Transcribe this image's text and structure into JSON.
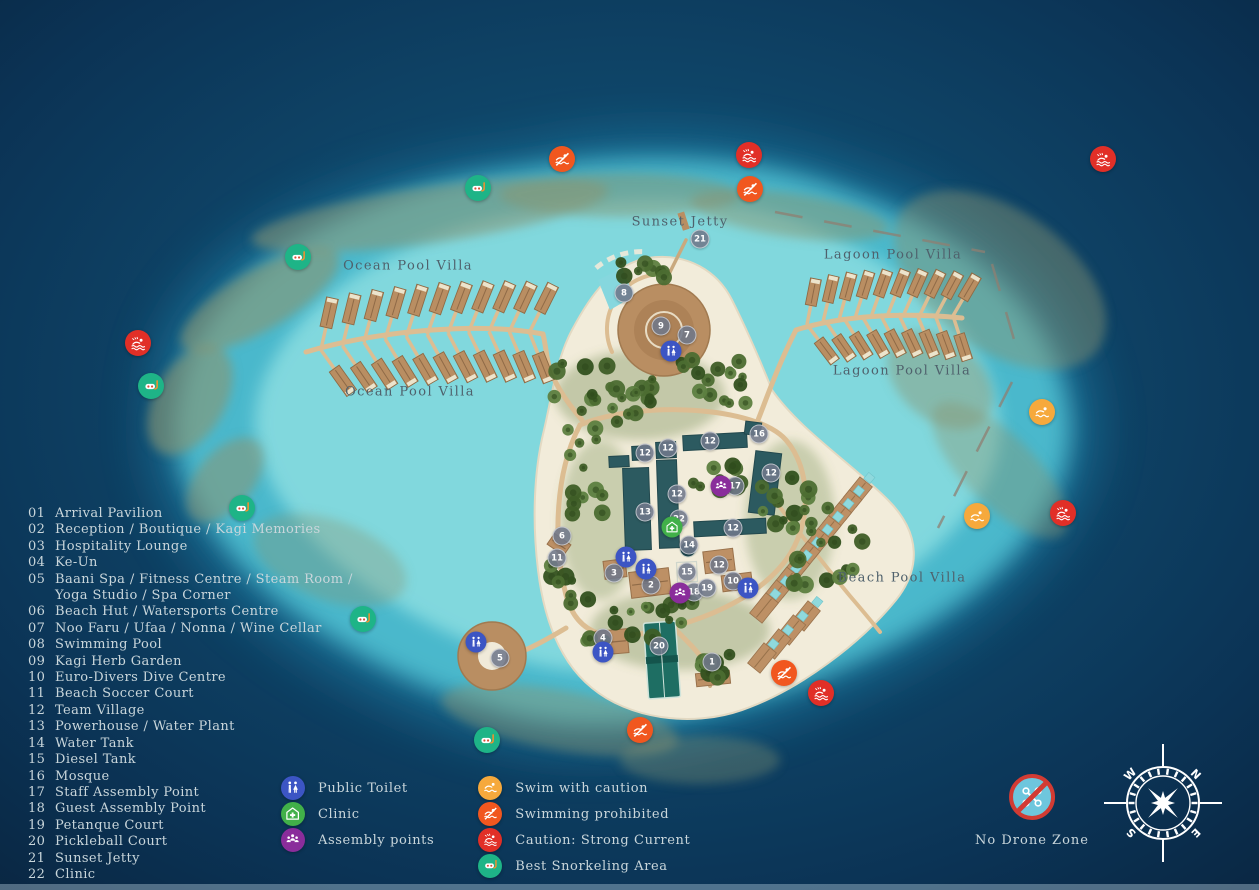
{
  "legend": {
    "items": [
      {
        "num": "01",
        "lines": [
          "Arrival Pavilion"
        ]
      },
      {
        "num": "02",
        "lines": [
          "Reception / Boutique / Kagi Memories"
        ]
      },
      {
        "num": "03",
        "lines": [
          "Hospitality Lounge"
        ]
      },
      {
        "num": "04",
        "lines": [
          "Ke-Un"
        ]
      },
      {
        "num": "05",
        "lines": [
          "Baani Spa / Fitness Centre / Steam Room /",
          "Yoga Studio  / Spa Corner"
        ]
      },
      {
        "num": "06",
        "lines": [
          "Beach Hut / Watersports Centre"
        ]
      },
      {
        "num": "07",
        "lines": [
          "Noo Faru / Ufaa / Nonna / Wine Cellar"
        ]
      },
      {
        "num": "08",
        "lines": [
          "Swimming Pool"
        ]
      },
      {
        "num": "09",
        "lines": [
          "Kagi Herb Garden"
        ]
      },
      {
        "num": "10",
        "lines": [
          "Euro-Divers Dive Centre"
        ]
      },
      {
        "num": "11",
        "lines": [
          "Beach Soccer Court"
        ]
      },
      {
        "num": "12",
        "lines": [
          "Team Village"
        ]
      },
      {
        "num": "13",
        "lines": [
          "Powerhouse / Water Plant"
        ]
      },
      {
        "num": "14",
        "lines": [
          "Water Tank"
        ]
      },
      {
        "num": "15",
        "lines": [
          "Diesel Tank"
        ]
      },
      {
        "num": "16",
        "lines": [
          "Mosque"
        ]
      },
      {
        "num": "17",
        "lines": [
          "Staff Assembly Point"
        ]
      },
      {
        "num": "18",
        "lines": [
          "Guest Assembly Point"
        ]
      },
      {
        "num": "19",
        "lines": [
          "Petanque Court"
        ]
      },
      {
        "num": "20",
        "lines": [
          "Pickleball Court"
        ]
      },
      {
        "num": "21",
        "lines": [
          "Sunset Jetty"
        ]
      },
      {
        "num": "22",
        "lines": [
          "Clinic"
        ]
      }
    ]
  },
  "key": {
    "columns": [
      [
        {
          "icon": "toilet",
          "label": "Public Toilet"
        },
        {
          "icon": "clinic",
          "label": "Clinic"
        },
        {
          "icon": "assembly",
          "label": "Assembly points"
        }
      ],
      [
        {
          "icon": "caution",
          "label": "Swim with caution"
        },
        {
          "icon": "prohibited",
          "label": "Swimming prohibited"
        },
        {
          "icon": "current",
          "label": "Caution: Strong Current"
        },
        {
          "icon": "snorkel",
          "label": "Best Snorkeling Area"
        }
      ]
    ]
  },
  "no_drone": {
    "label": "No Drone Zone"
  },
  "compass": {
    "n": "N",
    "e": "E",
    "s": "S",
    "w": "W"
  },
  "map_labels": [
    {
      "text": "Sunset Jetty",
      "x": 680,
      "y": 222
    },
    {
      "text": "Ocean Pool Villa",
      "x": 408,
      "y": 266
    },
    {
      "text": "Ocean Pool Villa",
      "x": 410,
      "y": 392
    },
    {
      "text": "Lagoon Pool Villa",
      "x": 893,
      "y": 255
    },
    {
      "text": "Lagoon Pool Villa",
      "x": 902,
      "y": 371
    },
    {
      "text": "Beach Pool Villa",
      "x": 902,
      "y": 578
    }
  ],
  "markers": [
    {
      "n": "1",
      "x": 712,
      "y": 662
    },
    {
      "n": "2",
      "x": 651,
      "y": 585
    },
    {
      "n": "3",
      "x": 614,
      "y": 573
    },
    {
      "n": "4",
      "x": 603,
      "y": 638
    },
    {
      "n": "5",
      "x": 500,
      "y": 658
    },
    {
      "n": "6",
      "x": 562,
      "y": 536
    },
    {
      "n": "7",
      "x": 687,
      "y": 335
    },
    {
      "n": "8",
      "x": 624,
      "y": 293
    },
    {
      "n": "9",
      "x": 661,
      "y": 326
    },
    {
      "n": "10",
      "x": 733,
      "y": 581
    },
    {
      "n": "11",
      "x": 557,
      "y": 558
    },
    {
      "n": "12",
      "x": 645,
      "y": 453
    },
    {
      "n": "12",
      "x": 668,
      "y": 448
    },
    {
      "n": "12",
      "x": 710,
      "y": 441
    },
    {
      "n": "12",
      "x": 771,
      "y": 473
    },
    {
      "n": "12",
      "x": 677,
      "y": 494
    },
    {
      "n": "12",
      "x": 733,
      "y": 528
    },
    {
      "n": "12",
      "x": 719,
      "y": 565
    },
    {
      "n": "13",
      "x": 645,
      "y": 512
    },
    {
      "n": "14",
      "x": 689,
      "y": 545
    },
    {
      "n": "15",
      "x": 687,
      "y": 572
    },
    {
      "n": "16",
      "x": 759,
      "y": 434
    },
    {
      "n": "17",
      "x": 735,
      "y": 486
    },
    {
      "n": "18",
      "x": 694,
      "y": 592
    },
    {
      "n": "19",
      "x": 707,
      "y": 588
    },
    {
      "n": "20",
      "x": 659,
      "y": 646
    },
    {
      "n": "21",
      "x": 700,
      "y": 239
    },
    {
      "n": "22",
      "x": 679,
      "y": 519
    }
  ],
  "map_icons": [
    {
      "type": "toilet",
      "x": 671,
      "y": 351,
      "size": "sm"
    },
    {
      "type": "toilet",
      "x": 626,
      "y": 557,
      "size": "sm"
    },
    {
      "type": "toilet",
      "x": 646,
      "y": 569,
      "size": "sm"
    },
    {
      "type": "toilet",
      "x": 603,
      "y": 652,
      "size": "sm"
    },
    {
      "type": "toilet",
      "x": 748,
      "y": 588,
      "size": "sm"
    },
    {
      "type": "toilet",
      "x": 476,
      "y": 642,
      "size": "sm"
    },
    {
      "type": "clinic",
      "x": 672,
      "y": 527,
      "size": "sm"
    },
    {
      "type": "assembly",
      "x": 721,
      "y": 486,
      "size": "sm"
    },
    {
      "type": "assembly",
      "x": 680,
      "y": 593,
      "size": "sm"
    },
    {
      "type": "snorkel",
      "x": 478,
      "y": 188,
      "size": "lg"
    },
    {
      "type": "snorkel",
      "x": 298,
      "y": 257,
      "size": "lg"
    },
    {
      "type": "snorkel",
      "x": 151,
      "y": 386,
      "size": "lg"
    },
    {
      "type": "snorkel",
      "x": 242,
      "y": 508,
      "size": "lg"
    },
    {
      "type": "snorkel",
      "x": 363,
      "y": 619,
      "size": "lg"
    },
    {
      "type": "snorkel",
      "x": 487,
      "y": 740,
      "size": "lg"
    },
    {
      "type": "prohibited",
      "x": 562,
      "y": 159,
      "size": "lg"
    },
    {
      "type": "prohibited",
      "x": 750,
      "y": 189,
      "size": "lg"
    },
    {
      "type": "prohibited",
      "x": 640,
      "y": 730,
      "size": "lg"
    },
    {
      "type": "prohibited",
      "x": 784,
      "y": 673,
      "size": "lg"
    },
    {
      "type": "current",
      "x": 749,
      "y": 155,
      "size": "lg"
    },
    {
      "type": "current",
      "x": 1103,
      "y": 159,
      "size": "lg"
    },
    {
      "type": "current",
      "x": 138,
      "y": 343,
      "size": "lg"
    },
    {
      "type": "current",
      "x": 1063,
      "y": 513,
      "size": "lg"
    },
    {
      "type": "current",
      "x": 821,
      "y": 693,
      "size": "lg"
    },
    {
      "type": "caution",
      "x": 1042,
      "y": 412,
      "size": "lg"
    },
    {
      "type": "caution",
      "x": 977,
      "y": 516,
      "size": "lg"
    }
  ],
  "colors": {
    "toilet": "#3c55c4",
    "clinic": "#41b049",
    "assembly": "#8a2d9b",
    "caution": "#f6a93c",
    "prohibited": "#f1571f",
    "current": "#e12f27",
    "snorkel": "#1eb487",
    "marker": "#70778a",
    "drone_bg": "#6ec6dd",
    "drone_ring": "#d23b33",
    "legend_text": "#c9d6db",
    "label_text": "#4f616c"
  }
}
